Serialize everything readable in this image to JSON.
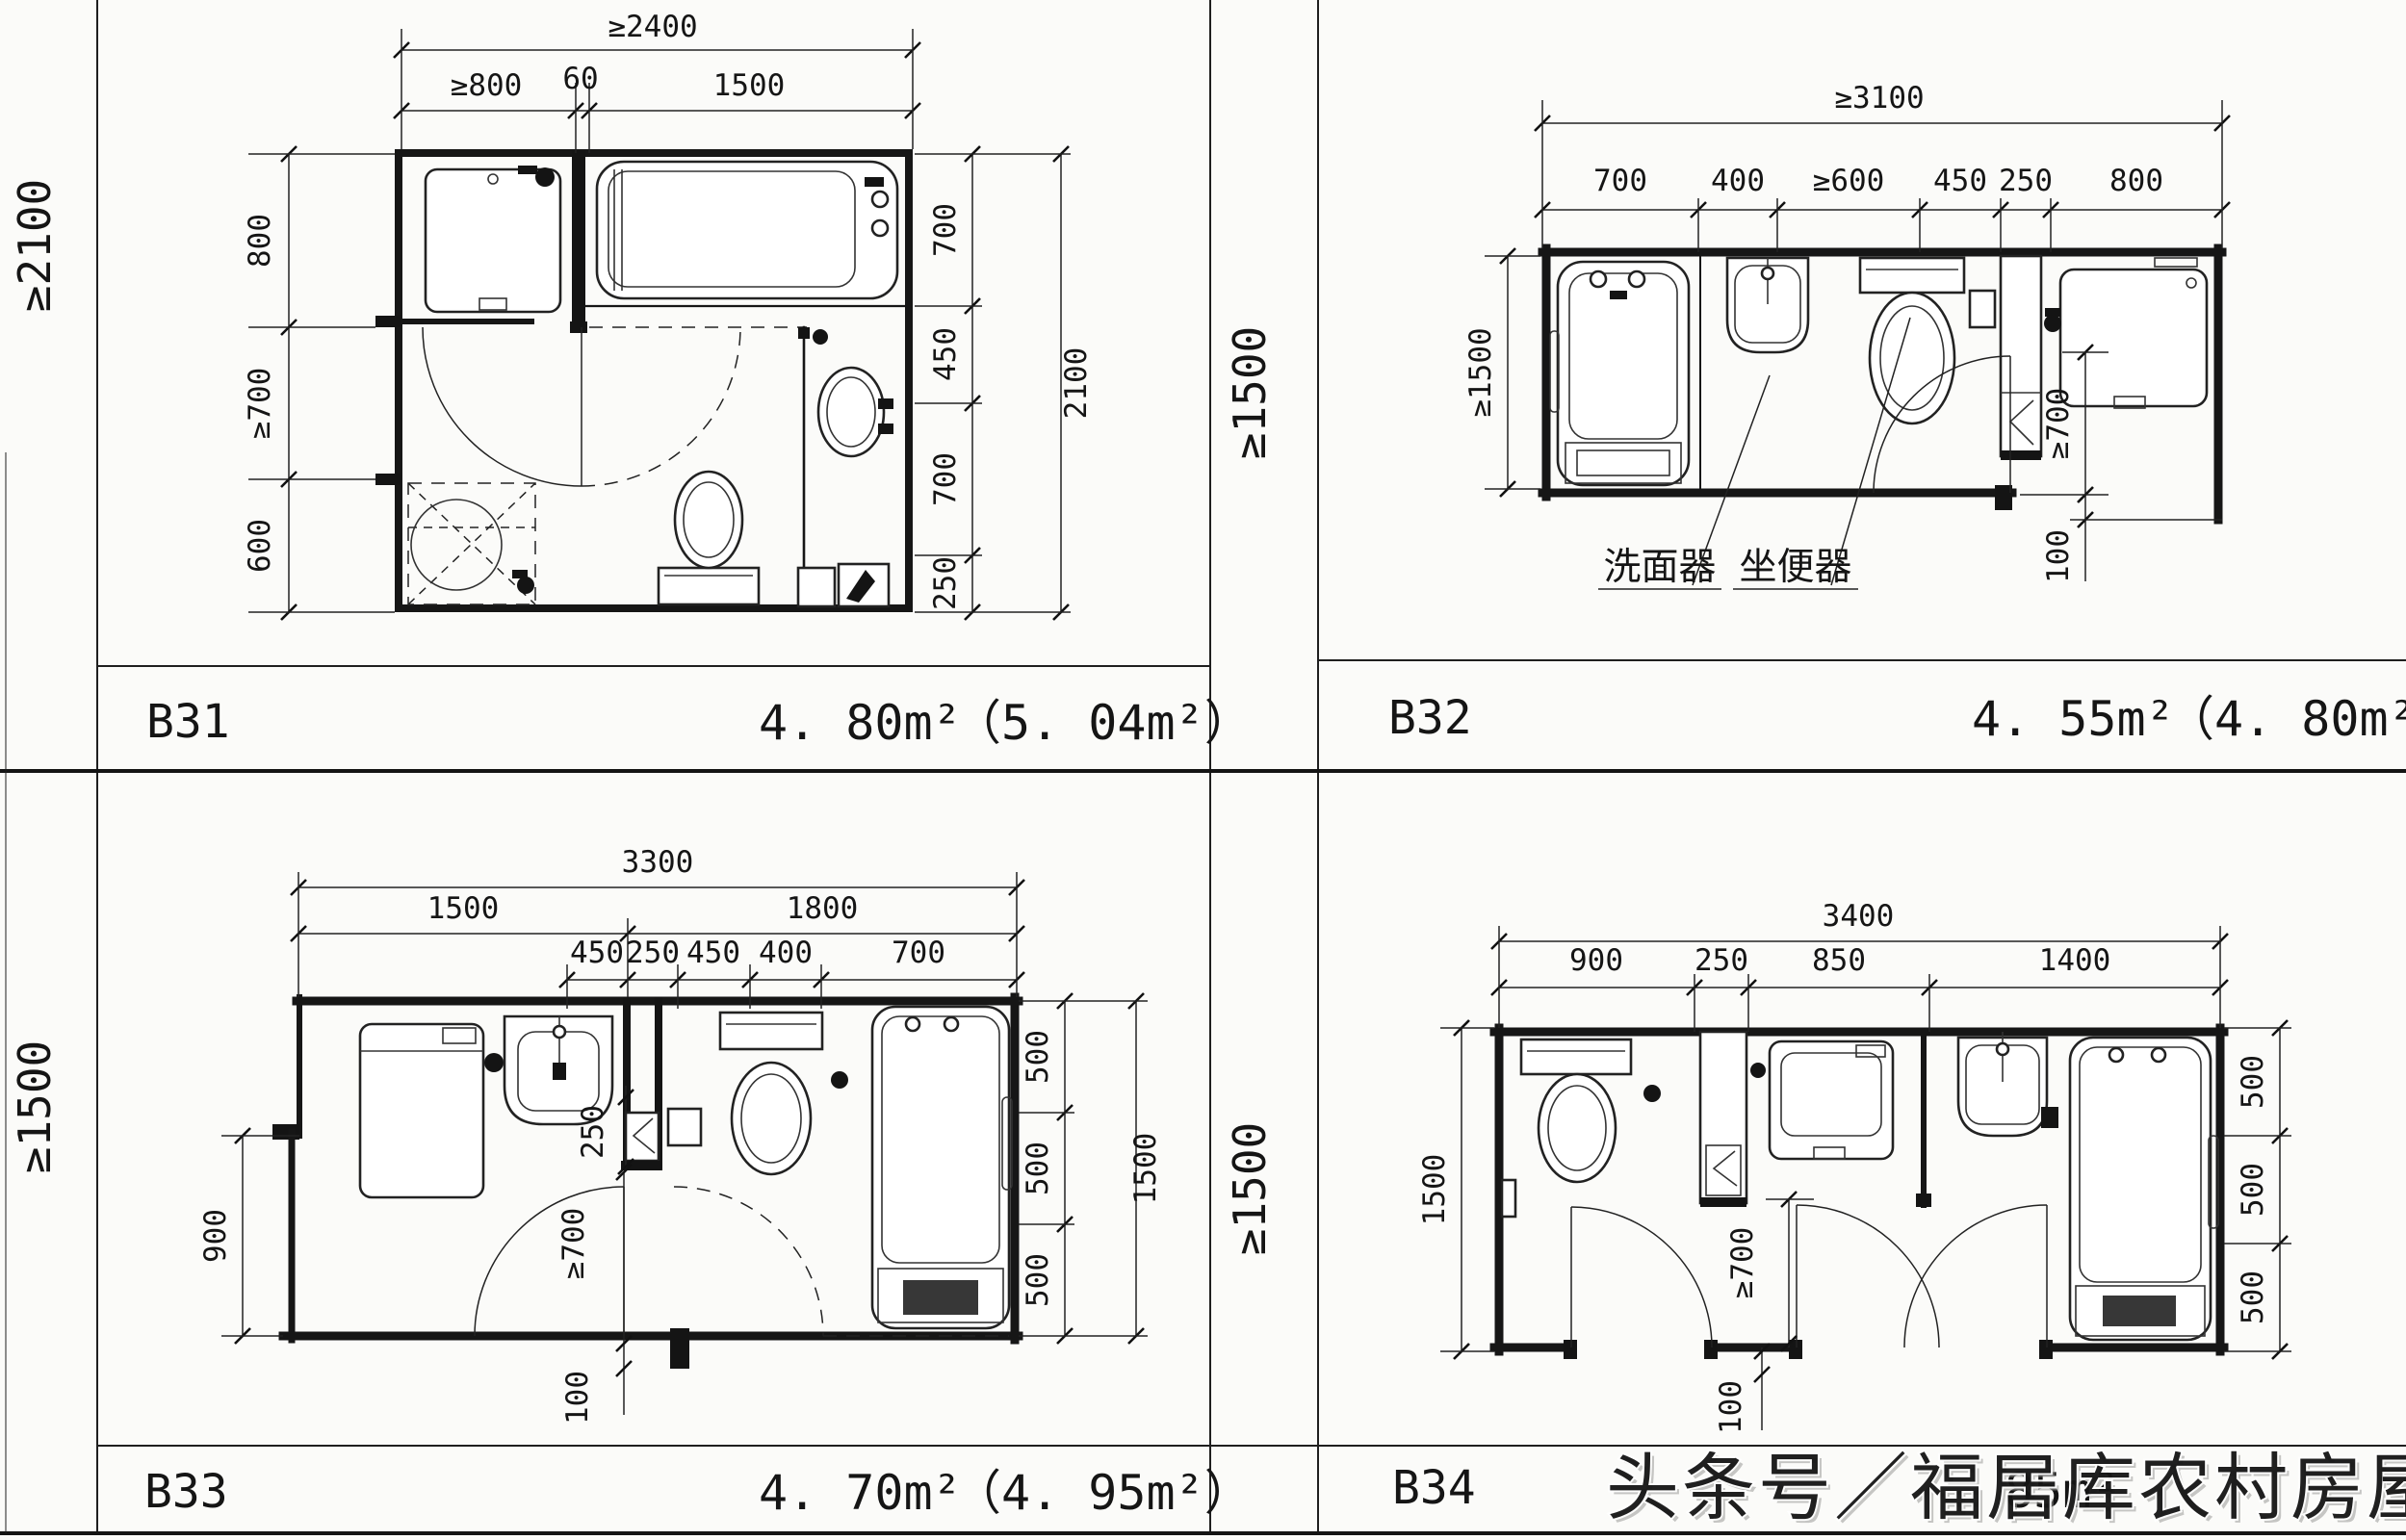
{
  "watermark": {
    "text": "头条号／福居库农村房屋设计",
    "color": "#c23b31"
  },
  "grid": {
    "row1_left_label": "≥2100",
    "row1_right_label": "≥1500",
    "row2_left_label": "≥1500",
    "row2_right_label": "≥1500"
  },
  "plans": {
    "b31": {
      "code": "B31",
      "area": "4. 80m²",
      "area_alt": "（5. 04m²）",
      "dims": {
        "total": "≥2400",
        "top": [
          "≥800",
          "60",
          "1500"
        ],
        "left": [
          "800",
          "≥700",
          "600"
        ],
        "right": [
          "700",
          "450",
          "700",
          "250"
        ],
        "right_total": "2100"
      }
    },
    "b32": {
      "code": "B32",
      "area": "4. 55m²",
      "area_alt": "（4. 80m²）",
      "dims": {
        "total": "≥3100",
        "top": [
          "700",
          "400",
          "≥600",
          "450",
          "250",
          "800"
        ],
        "left_total": "≥1500",
        "door": "≥700",
        "offset": "100"
      },
      "labels": {
        "washbasin": "洗面器",
        "toilet": "坐便器"
      }
    },
    "b33": {
      "code": "B33",
      "area": "4. 70m²",
      "area_alt": "（4. 95m²）",
      "dims": {
        "total": "3300",
        "mid": [
          "1500",
          "1800"
        ],
        "top": [
          "450",
          "250",
          "450",
          "400",
          "700"
        ],
        "left": "900",
        "right": [
          "500",
          "500",
          "500"
        ],
        "right_total": "1500",
        "duct": "250",
        "door": "≥700",
        "offset": "100"
      }
    },
    "b34": {
      "code": "B34",
      "area_partial": "85m²",
      "dims": {
        "total": "3400",
        "top": [
          "900",
          "250",
          "850",
          "1400"
        ],
        "left": "1500",
        "right": [
          "500",
          "500",
          "500"
        ],
        "door": "≥700",
        "offset": "100"
      }
    }
  }
}
